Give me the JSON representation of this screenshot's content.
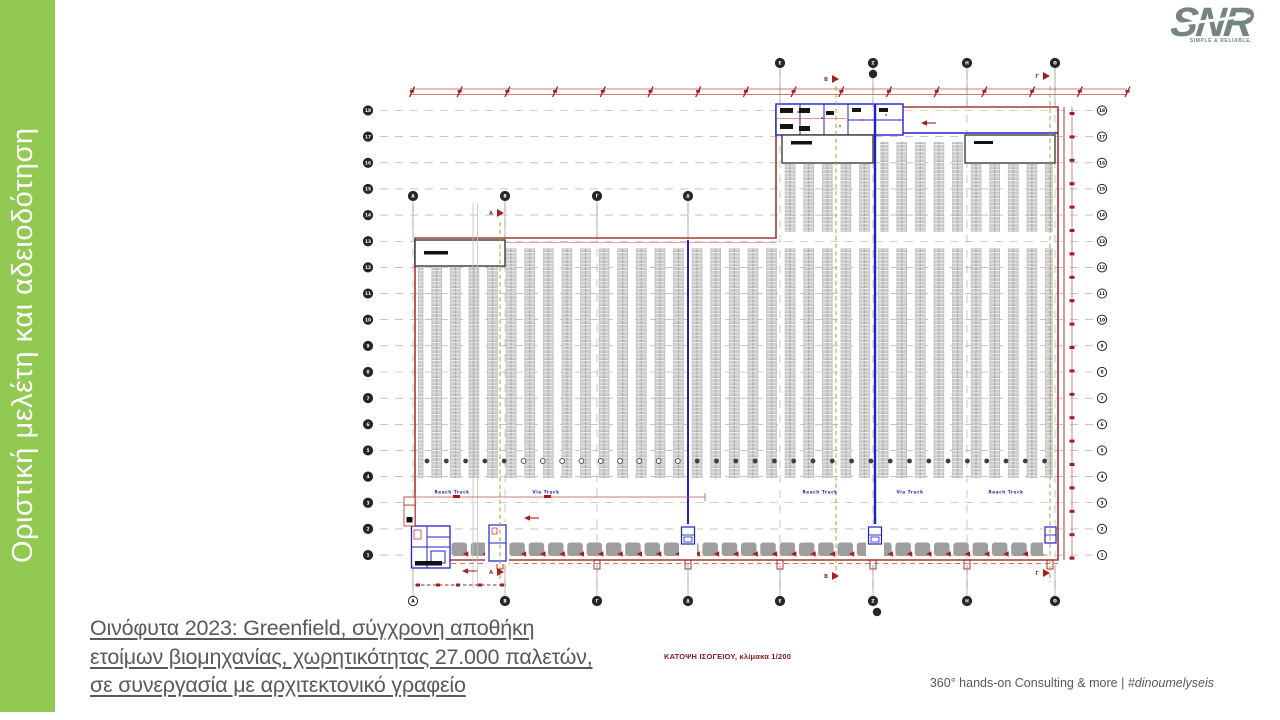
{
  "sidebar": {
    "title": "Οριστική μελέτη και αδειοδότηση"
  },
  "caption": {
    "lines": [
      "Οινόφυτα 2023: Greenfield, σύγχρονη αποθήκη",
      "ετοίμων βιομηχανίας, χωρητικότητας 27.000 παλετών,",
      "σε συνεργασία με αρχιτεκτονικό γραφείο"
    ]
  },
  "plan": {
    "drawing_label": "ΚΑΤΟΨΗ ΙΣΟΓΕΙΟΥ, κλίμακα 1/200",
    "grid": {
      "row_labels": [
        "18",
        "17",
        "16",
        "15",
        "14",
        "13",
        "12",
        "11",
        "10",
        "9",
        "8",
        "7",
        "6",
        "5",
        "4",
        "3",
        "2",
        "1"
      ],
      "col_labels_numbers": [
        "Ε",
        "Ζ",
        "Η",
        "Θ"
      ],
      "col_labels_letters": [
        "Α",
        "Β",
        "Γ",
        "Δ"
      ]
    },
    "aisle_labels": [
      "Reach Truck",
      "Via Truck",
      "Reach Truck",
      "Via Truck",
      "Reach Truck"
    ],
    "section_flags": [
      "Α",
      "Β",
      "Γ"
    ],
    "counts": {
      "grid_rows": 18,
      "dock_doors": 31,
      "column_dots": 33,
      "dim_ticks": 16,
      "right_ticks": 20
    }
  },
  "footer": {
    "text": "360° hands-on Consulting & more |",
    "hashtag": "#dinoumelyseis"
  },
  "logo": {
    "name": "SNR",
    "tagline": "SIMPLE & RELIABLE."
  },
  "colors": {
    "accent_green": "#92c953",
    "plan_red": "#a5382e",
    "dim_red": "#c0504d",
    "bold_red": "#a31f1f",
    "plan_blue": "#2121cc",
    "grid_gray": "#a3a3a3",
    "section_orange": "#b8922e",
    "dock_gray": "#9e9e9e",
    "caption_gray": "#595959",
    "logo_gray": "#76857f"
  }
}
